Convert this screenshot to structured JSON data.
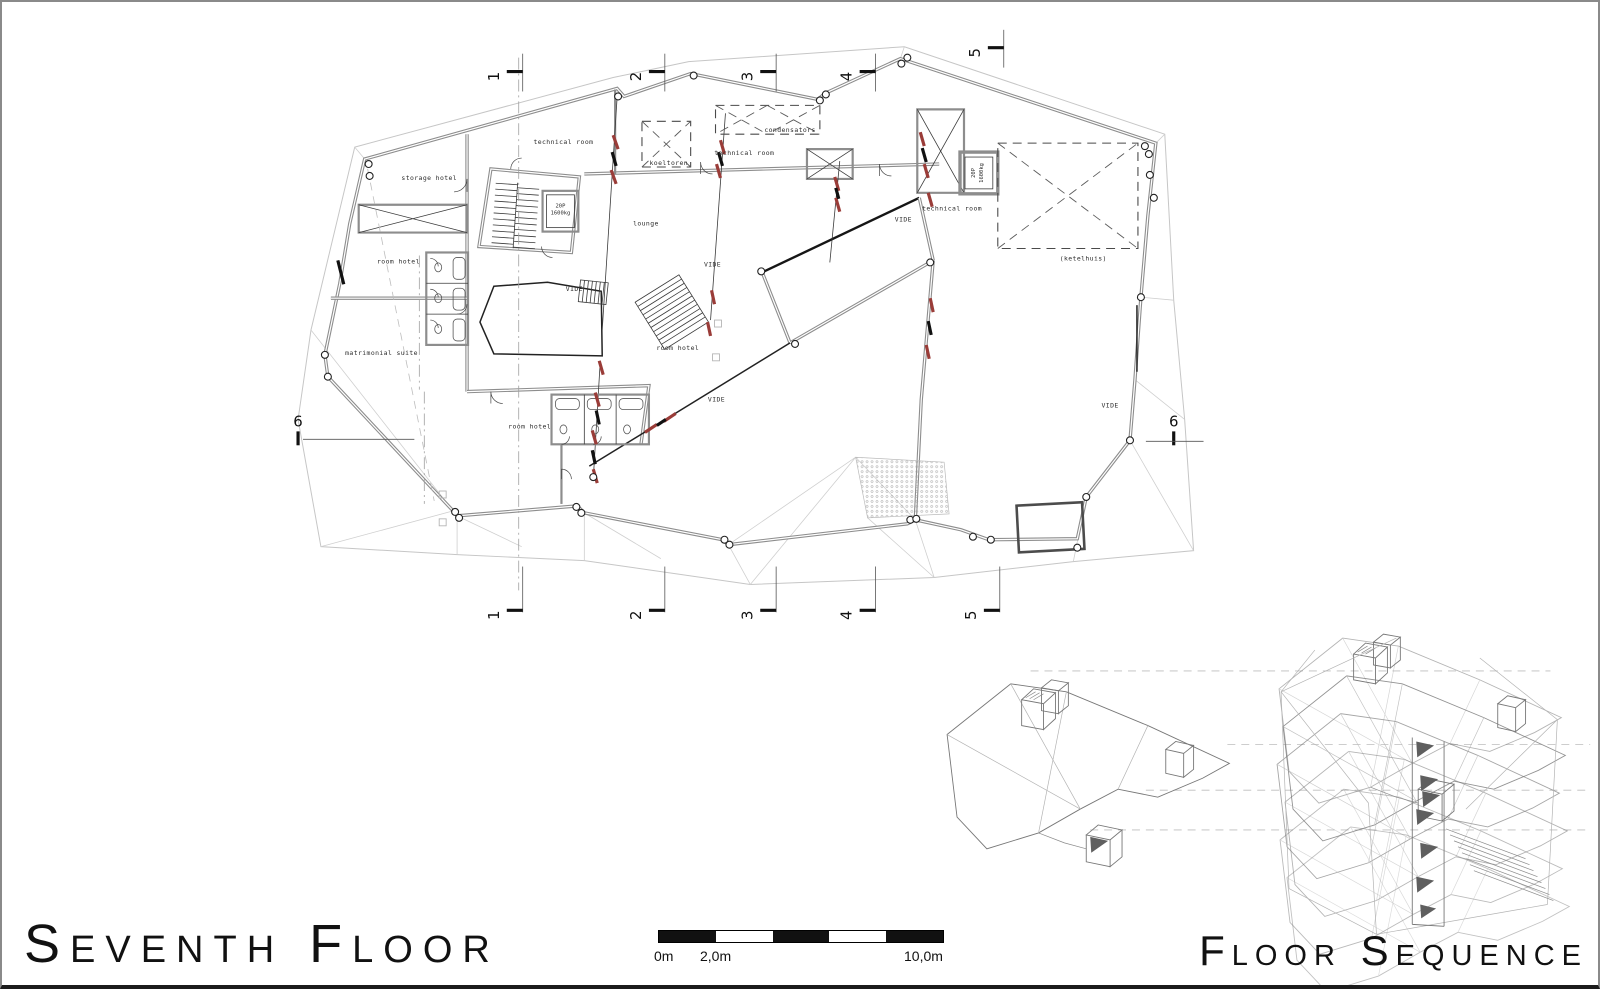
{
  "titles": {
    "left": "Seventh Floor",
    "right": "Floor Sequence"
  },
  "scale_bar": {
    "labels": [
      "0m",
      "2,0m",
      "10,0m"
    ]
  },
  "grid_markers": {
    "top": [
      "1",
      "2",
      "3",
      "4",
      "5"
    ],
    "bottom": [
      "1",
      "2",
      "3",
      "4",
      "5"
    ],
    "left": [
      "6"
    ],
    "right": [
      "6"
    ]
  },
  "rooms": {
    "technical_room_top": "technical room",
    "technical_room_mid": "technical room",
    "technical_room_right": "technical room",
    "koeltoren": "koeltoren",
    "condensators": "condensators",
    "storage_hotel": "storage hotel",
    "room_hotel_left": "room hotel",
    "room_hotel_center": "room hotel",
    "room_hotel_bottom": "room hotel",
    "matrimonial_suite": "matrimonial suite",
    "lounge": "lounge",
    "ketelhuis": "(ketelhuis)",
    "vide_center": "VIDE",
    "vide_mid": "VIDE",
    "vide_small": "VIDE",
    "vide_lower": "VIDE",
    "vide_right": "VIDE"
  },
  "elevator": {
    "capacity": "20P",
    "load": "1600kg"
  },
  "colors": {
    "accent_red": "#9a3c38",
    "wall_gray": "#8d8d8d",
    "roof_gray": "#c6c6c6",
    "ink": "#161616",
    "page_border": "#8a8a8a"
  }
}
